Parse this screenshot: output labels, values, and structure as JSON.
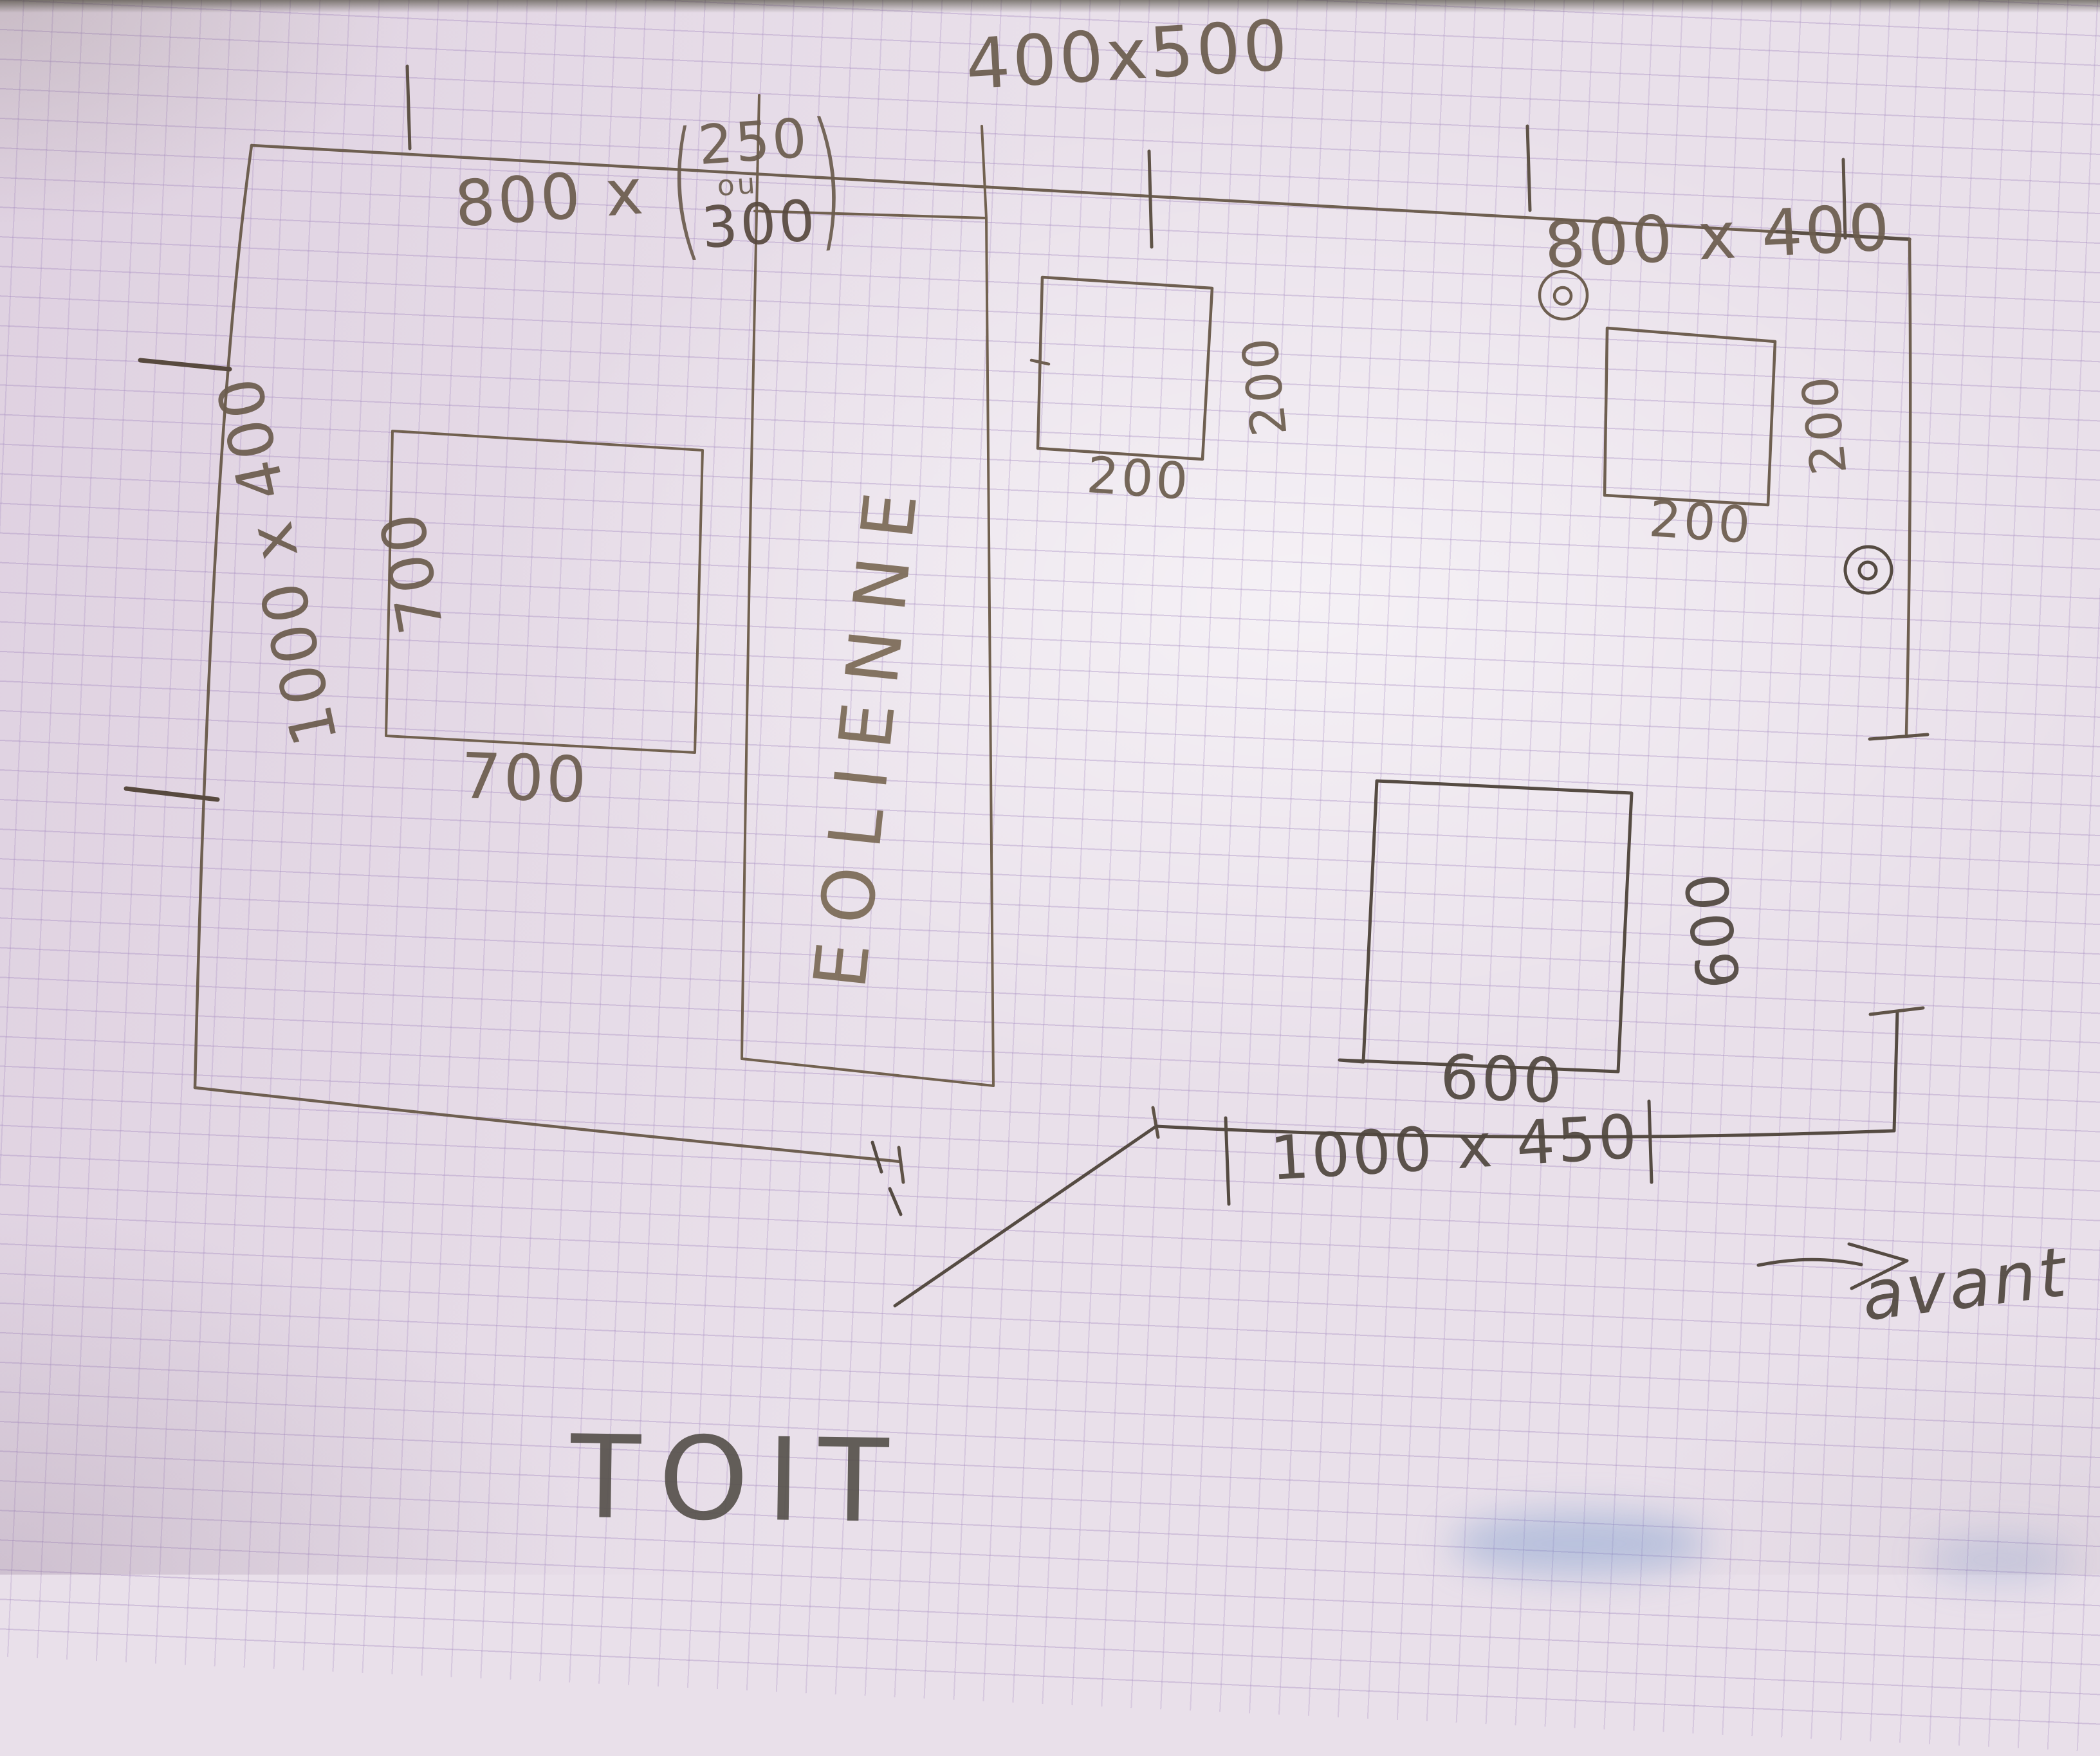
{
  "document": {
    "kind": "hand-drawn roof plan on graph paper",
    "title": "TOIT"
  },
  "dimensions": {
    "top_center": "400x500",
    "top_left": {
      "prefix": "800 x",
      "open": "(",
      "option_a": "250",
      "conjunction": "ou",
      "option_b": "300",
      "close": ")"
    },
    "top_right": "800 x 400",
    "left_side": "1000 x 400",
    "bottom": "1000 x 450"
  },
  "features": {
    "turbine_label": "EOLIENNE",
    "squares": [
      {
        "name": "square-700",
        "side_label": "700",
        "bottom_label": "700"
      },
      {
        "name": "square-200-middle",
        "side_label": "200",
        "bottom_label": "200"
      },
      {
        "name": "square-200-right",
        "side_label": "200",
        "bottom_label": "200"
      },
      {
        "name": "square-600",
        "side_label": "600",
        "bottom_label": "600"
      }
    ]
  },
  "orientation": {
    "front_label": "avant"
  },
  "colors": {
    "paper": "#e9e0ea",
    "grid_line": "#9e82bc",
    "pencil": "#6e5f50",
    "pencil_dark": "#554b42",
    "smudge_blue": "#6e91c8"
  }
}
